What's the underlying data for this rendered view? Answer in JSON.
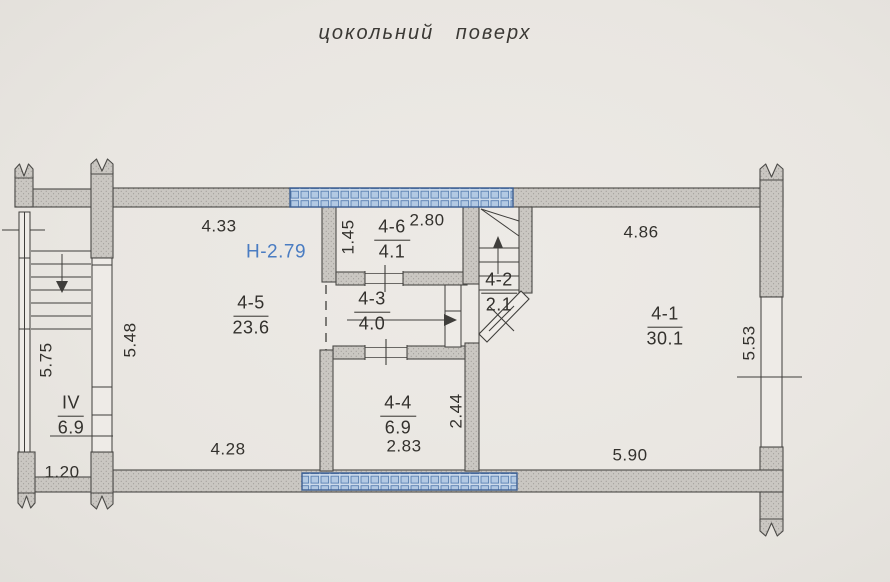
{
  "title": "цокольний поверх",
  "height_note": {
    "label": "Н-2.79",
    "color": "#4a7cc2"
  },
  "rooms": {
    "r41": {
      "id": "4-1",
      "area": "30.1"
    },
    "r42": {
      "id": "4-2",
      "area": "2.1"
    },
    "r43": {
      "id": "4-3",
      "area": "4.0"
    },
    "r44": {
      "id": "4-4",
      "area": "6.9"
    },
    "r45": {
      "id": "4-5",
      "area": "23.6"
    },
    "r46": {
      "id": "4-6",
      "area": "4.1"
    },
    "rIV": {
      "id": "IV",
      "area": "6.9"
    }
  },
  "dimensions": {
    "d433": "4.33",
    "d280": "2.80",
    "d486": "4.86",
    "d145": "1.45",
    "d548": "5.48",
    "d575": "5.75",
    "d244": "2.44",
    "d553": "5.53",
    "d283": "2.83",
    "d428": "4.28",
    "d590": "5.90",
    "d120": "1.20"
  },
  "colors": {
    "paper": "#eae7e2",
    "wall_fill": "#cac7c2",
    "wall_stroke": "#4b4a47",
    "window_fill": "#ccdbeb",
    "window_border": "#3d5f92",
    "text": "#33312d",
    "accent_blue": "#4a7cc2"
  }
}
